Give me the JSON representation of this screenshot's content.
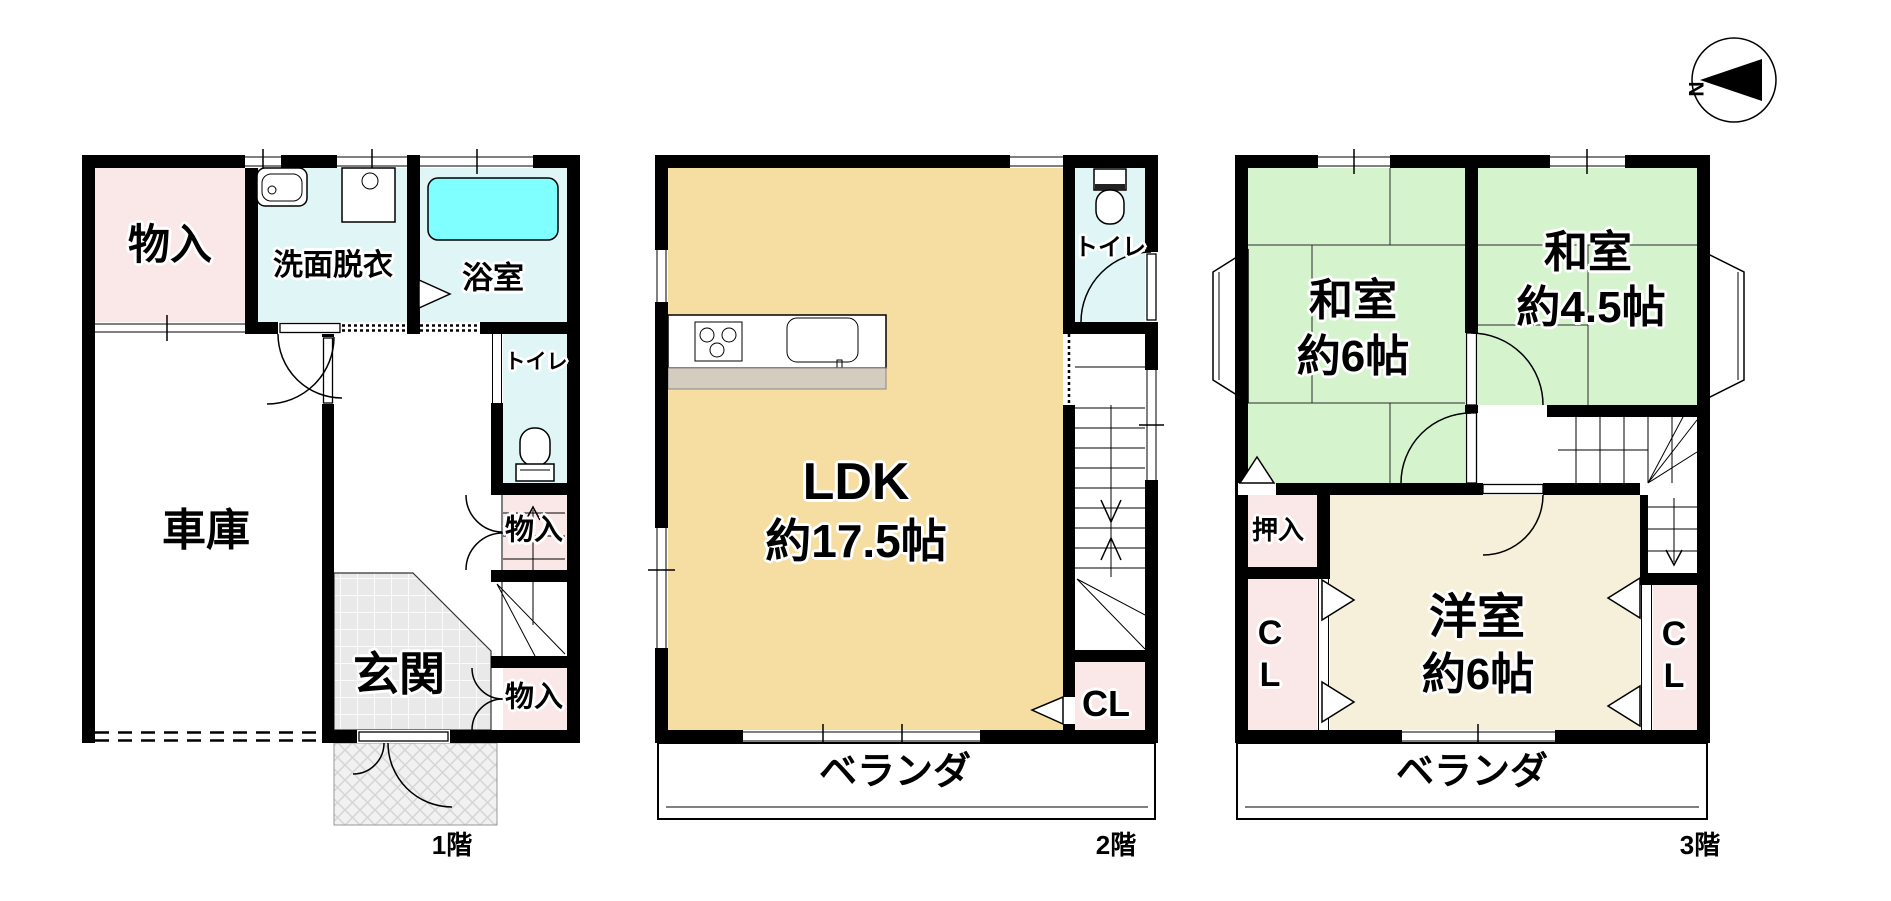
{
  "compass": {
    "north_label": "N"
  },
  "floor1": {
    "floor_label": "1階",
    "storage_top": "物入",
    "washroom": "洗面脱衣",
    "bathroom": "浴室",
    "garage": "車庫",
    "toilet": "トイレ",
    "storage_mid": "物入",
    "entrance": "玄関",
    "storage_bottom": "物入"
  },
  "floor2": {
    "floor_label": "2階",
    "ldk_name": "LDK",
    "ldk_size": "約17.5帖",
    "toilet": "トイレ",
    "closet": "CL",
    "veranda": "ベランダ"
  },
  "floor3": {
    "floor_label": "3階",
    "japanese_room_left_name": "和室",
    "japanese_room_left_size": "約6帖",
    "japanese_room_right_name": "和室",
    "japanese_room_right_size": "約4.5帖",
    "oshiire": "押入",
    "closet_left": "CL",
    "western_room_name": "洋室",
    "western_room_size": "約6帖",
    "closet_right": "CL",
    "veranda": "ベランダ"
  },
  "colors": {
    "wall": "#000000",
    "storage_pink": "#FAE8E8",
    "water_cyan": "#DFF5F6",
    "bathtub_cyan": "#7FFFFF",
    "ldk_tan": "#F6DEA2",
    "tatami_green": "#D5F4CE",
    "western_cream": "#F6EFD9",
    "counter_gray": "#D4CCBE",
    "tile_gray": "#E9E9E9"
  }
}
